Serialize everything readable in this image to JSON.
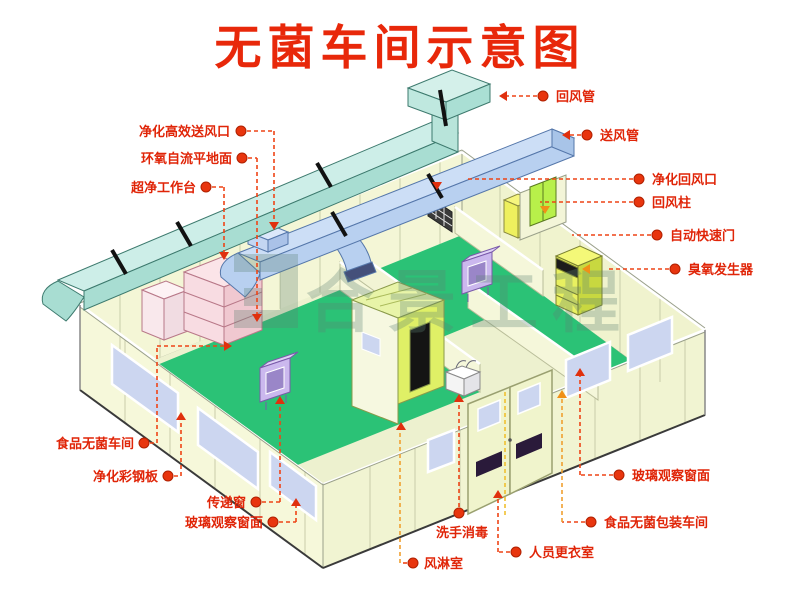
{
  "title": "无菌车间示意图",
  "watermark": {
    "text": "合景工程",
    "logo": "bracket-logo",
    "color": "#5e8374"
  },
  "colors": {
    "title_red": "#e8280a",
    "label_red": "#e02508",
    "leader_red": "#ee4416",
    "leader_orange": "#f0a030",
    "duct_cyan": "#cdeee8",
    "duct_blue": "#c2d8f2",
    "floor_green": "#2bc276",
    "corridor_pale": "#edf1cf",
    "wall_yellow": "#f4f6d6",
    "window_blue": "#ccd6f0",
    "bench_pink": "#f8dce2",
    "passbox_purple": "#cbb8ee",
    "airshower_green": "#dff066"
  },
  "labels": {
    "hepa_supply_outlet": "净化高效送风口",
    "epoxy_self_leveling_floor": "环氧自流平地面",
    "clean_bench": "超净工作台",
    "food_sterile_workshop": "食品无菌车间",
    "purification_steel_panel": "净化彩钢板",
    "pass_window": "传递窗",
    "glass_observation_window_left": "玻璃观察窗面",
    "return_air_duct": "回风管",
    "supply_air_duct": "送风管",
    "purified_return_air_inlet": "净化回风口",
    "return_air_column": "回风柱",
    "automatic_quick_door": "自动快速门",
    "ozone_generator": "臭氧发生器",
    "glass_observation_window_right": "玻璃观察窗面",
    "food_sterile_packing_workshop": "食品无菌包装车间",
    "staff_changing_room": "人员更衣室",
    "hand_wash_disinfection": "洗手消毒",
    "air_shower_room": "风淋室"
  }
}
